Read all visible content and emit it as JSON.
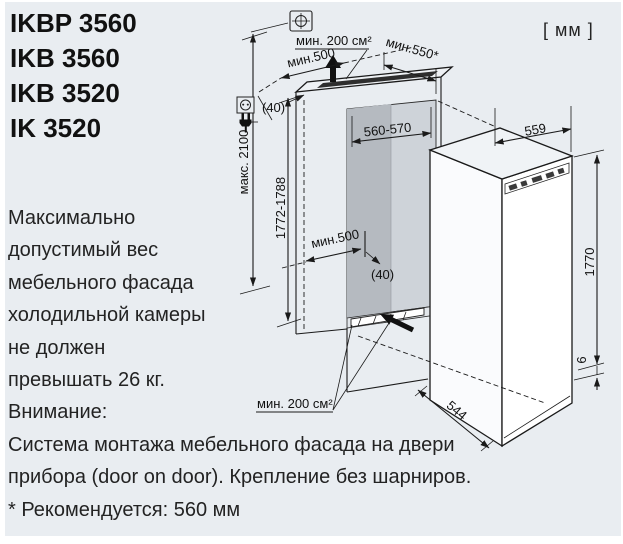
{
  "page": {
    "units_label": "[ мм ]",
    "models": [
      "IKBP 3560",
      "IKB 3560",
      "IKB 3520",
      "IK 3520"
    ],
    "note_lines": [
      "Максимально",
      "допустимый вес",
      "мебельного фасада",
      "холодильной камеры",
      "не должен",
      "превышать 26 кг.",
      "Внимание:",
      "Система монтажа мебельного фасада на двери",
      "прибора (door on door). Крепление без шарниров.",
      "* Рекомендуется: 560 мм"
    ]
  },
  "diagram": {
    "labels": {
      "max_socket_height": "макс. 2100",
      "niche_height": "1772-1788",
      "vent_area_top": "мин. 200 см²",
      "vent_area_bottom": "мин. 200 см²",
      "depth_min_top": "мин.500",
      "depth_min_bottom": "мин.500",
      "niche_depth_recommended": "мин.550*",
      "niche_width": "560-570",
      "gap_top": "(40)",
      "gap_bottom": "(40)",
      "appliance_width": "559",
      "appliance_height": "1770",
      "appliance_depth": "544",
      "bottom_clearance": "6"
    }
  },
  "colors": {
    "background": "#e9edf1",
    "line": "#1a1a1a",
    "niche_interior_dark": "#b5bac0",
    "niche_interior_light": "#ced3d9",
    "vent_slot": "#2e2e2e"
  }
}
